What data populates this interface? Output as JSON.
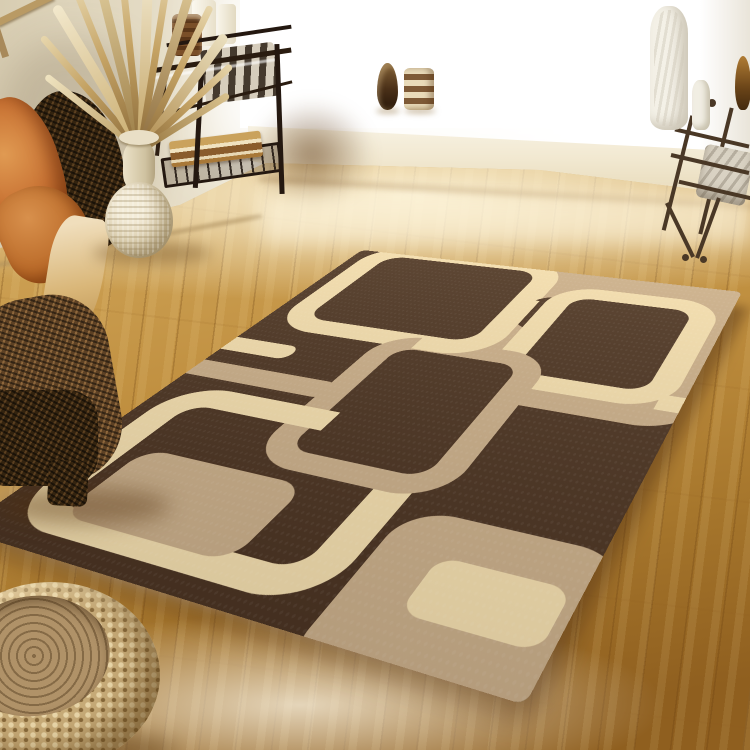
{
  "meta": {
    "image_type": "photograph",
    "subject": "Retro modern area rug displayed in a sunlit living room with wood flooring",
    "visible_text": "none"
  },
  "palette": {
    "rug_base_brown": "#4b3423",
    "rug_tan": "#c9ae8a",
    "rug_cream": "#f2ddae",
    "rug_edge_shadow": "#2e1f12",
    "floor_wood_light": "#ddb873",
    "floor_wood_mid": "#bf8e3e",
    "floor_wood_dark": "#8f5f1f",
    "wall_cream": "#efe8d4",
    "window_white": "#ffffff",
    "cushion_orange": "#c97334",
    "wicker_dark_brown": "#33230f",
    "wicker_pouf_straw": "#c7ab78",
    "vase_cream": "#ddd0b0",
    "metal_dark": "#241810"
  },
  "scene": {
    "rug": {
      "style": "retro overlapping rounded squares",
      "motifs": [
        {
          "name": "cream-outline-square-top-left",
          "fill": "none",
          "stroke": "#f2ddae"
        },
        {
          "name": "tan-filled-square-top-center-right",
          "fill": "#c9ae8a"
        },
        {
          "name": "dark-notch-on-tan",
          "fill": "#4b3423"
        },
        {
          "name": "cream-outline-square-top-right",
          "fill": "#4b3423",
          "stroke": "#f2ddae"
        },
        {
          "name": "cream-connector-band-right-edge",
          "fill": "#f2ddae"
        },
        {
          "name": "cream-connector-band-left-edge",
          "fill": "#f2ddae"
        },
        {
          "name": "tan-connector-band-left-edge",
          "fill": "#c9ae8a"
        },
        {
          "name": "large-cream-outline-square-bottom-left",
          "fill": "none",
          "stroke": "#f2ddae"
        },
        {
          "name": "tan-small-square-inside-cream",
          "fill": "#c9ae8a"
        },
        {
          "name": "tan-outline-square-center",
          "fill": "#4b3423",
          "stroke": "#c9ae8a"
        },
        {
          "name": "tan-filled-square-bottom-right",
          "fill": "#c9ae8a"
        },
        {
          "name": "cream-small-square-inside-tan",
          "fill": "#f2ddae"
        }
      ]
    },
    "objects": [
      {
        "name": "wicker-armchair",
        "position": "left edge",
        "details": "dark woven chair with burnt-orange cushion and cream pillow"
      },
      {
        "name": "woven-gourd-vase",
        "position": "left, on floor",
        "details": "cream woven vase with tall dried reed stems"
      },
      {
        "name": "metal-console-table",
        "position": "top left",
        "details": "dark metal frame, glass top, striped fabric panel, books on lower shelf, candles on top"
      },
      {
        "name": "window-with-sill",
        "position": "top right",
        "details": "bright daylight, white ledge with decorative vases"
      },
      {
        "name": "sill-vases",
        "position": "on window ledge",
        "details": "dark teardrop vase, striped candle, tall white textured vase, small white bottle, amber vase"
      },
      {
        "name": "wrought-iron-rack",
        "position": "right edge",
        "details": "thin metal posts with ball finials and light fabric"
      },
      {
        "name": "woven-round-pouf",
        "position": "bottom left corner",
        "details": "straw-colored crocheted pouf with coiled top"
      },
      {
        "name": "hardwood-floor",
        "details": "golden wood planks with bright window reflections"
      }
    ]
  }
}
